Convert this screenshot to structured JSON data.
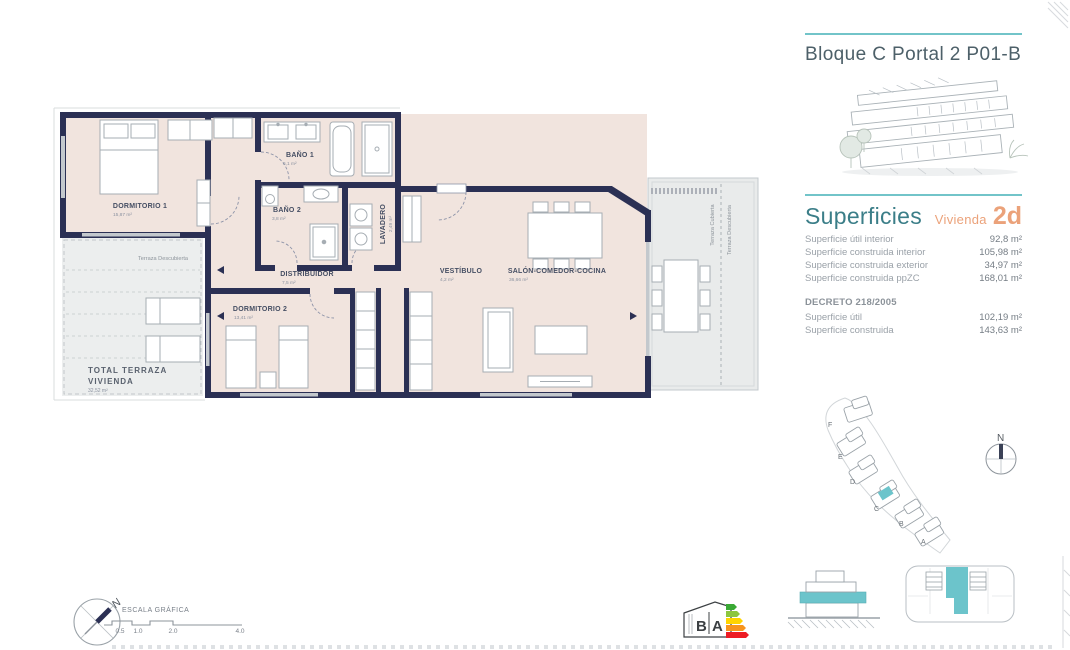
{
  "header": {
    "title": "Bloque C Portal 2 P01-B"
  },
  "superficies": {
    "title": "Superficies",
    "vivienda_label": "Vivienda",
    "vivienda_code": "2d",
    "rows": [
      {
        "label": "Superficie útil interior",
        "value": "92,8 m²"
      },
      {
        "label": "Superficie construida interior",
        "value": "105,98 m²"
      },
      {
        "label": "Superficie construida exterior",
        "value": "34,97 m²"
      },
      {
        "label": "Superficie construida ppZC",
        "value": "168,01 m²"
      }
    ],
    "decreto": {
      "title": "DECRETO 218/2005",
      "rows": [
        {
          "label": "Superficie útil",
          "value": "102,19 m²"
        },
        {
          "label": "Superficie construida",
          "value": "143,63 m²"
        }
      ]
    }
  },
  "floorplan": {
    "rooms": [
      {
        "name": "DORMITORIO 1",
        "area": "15,87 m²"
      },
      {
        "name": "BAÑO 1",
        "area": "6,1 m²"
      },
      {
        "name": "BAÑO 2",
        "area": "3,8 m²"
      },
      {
        "name": "LAVADERO",
        "area": "2,49 m²"
      },
      {
        "name": "DISTRIBUIDOR",
        "area": "7,5 m²"
      },
      {
        "name": "VESTÍBULO",
        "area": "4,2 m²"
      },
      {
        "name": "SALÓN-COMEDOR-COCINA",
        "area": "36,66 m²"
      },
      {
        "name": "DORMITORIO 2",
        "area": "13,41 m²"
      }
    ],
    "terraces": {
      "left_label": "Terraza Descubierta",
      "right_covered": "Terraza Cubierta",
      "right_open": "Terraza Descubierta",
      "total_line1": "TOTAL  TERRAZA",
      "total_line2": "VIVIENDA",
      "total_area": "32,52 m²"
    }
  },
  "siteplan": {
    "labels": [
      "F",
      "E",
      "D",
      "C",
      "B",
      "A"
    ],
    "north": "N"
  },
  "compass": {
    "north": "N"
  },
  "scalebar": {
    "title": "ESCALA GRÁFICA",
    "ticks": [
      "0.5",
      "1.0",
      "2.0",
      "4.0"
    ]
  },
  "energy_logo": {
    "b": "B",
    "a": "A"
  },
  "colors": {
    "teal": "#72c4c9",
    "teal_fill": "#6cc4cb",
    "orange": "#eba27a",
    "navy": "#2b3054"
  }
}
